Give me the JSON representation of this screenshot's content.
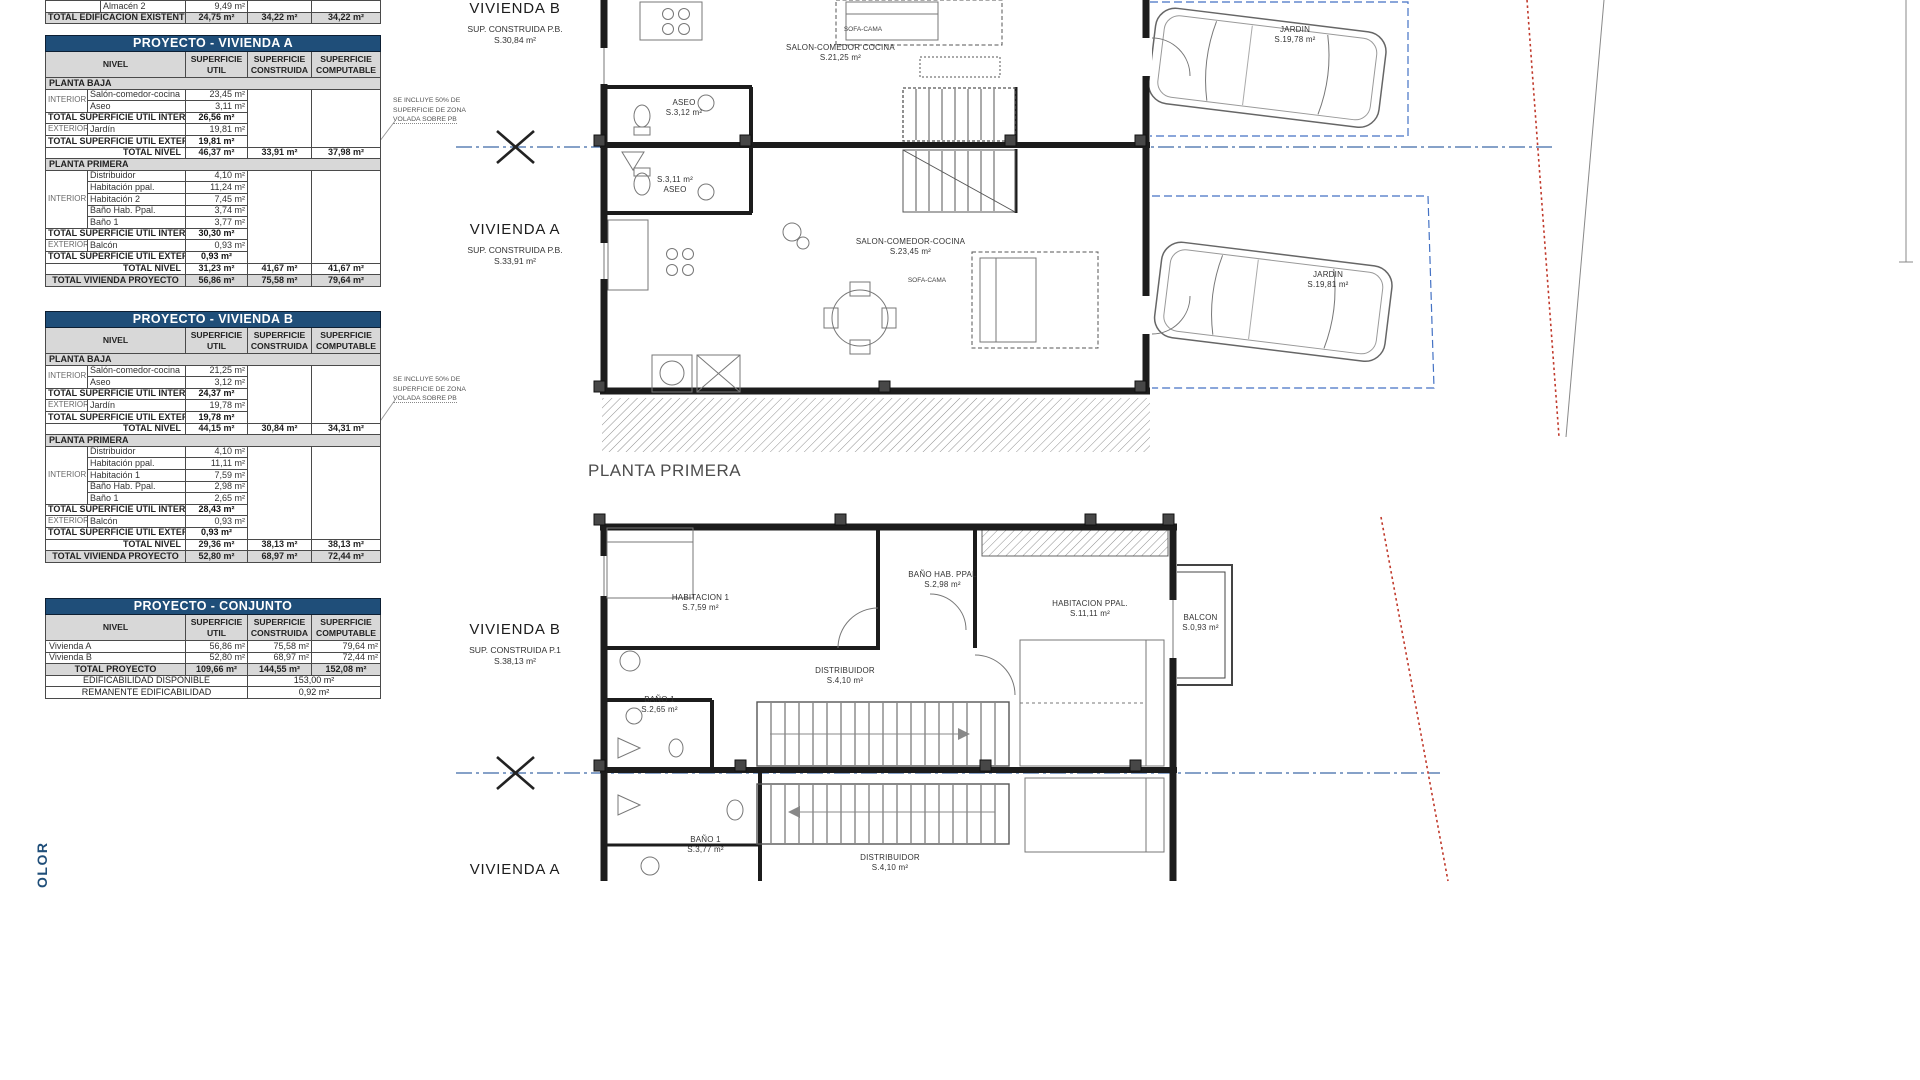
{
  "colors": {
    "header_blue": "#1f4e79",
    "row_grey": "#d8d8d8",
    "section_blue": "#3f69a8",
    "parcel_blue": "#4472c4",
    "boundary_red": "#c0392b"
  },
  "col_headers": {
    "nivel": "NIVEL",
    "util": [
      "SUPERFICIE",
      "UTIL"
    ],
    "construida": [
      "SUPERFICIE",
      "CONSTRUIDA"
    ],
    "computable": [
      "SUPERFICIE",
      "COMPUTABLE"
    ]
  },
  "labels": {
    "planta_baja": "PLANTA BAJA",
    "planta_primera": "PLANTA PRIMERA",
    "interior": "INTERIOR",
    "exterior": "EXTERIOR",
    "total_util_int": "TOTAL SUPERFICIE UTIL INTERIOR",
    "total_util_ext": "TOTAL SUPERFICIE UTIL EXTERIOR",
    "total_nivel": "TOTAL NIVEL",
    "total_vivienda": "TOTAL VIVIENDA PROYECTO"
  },
  "existing_table": {
    "row_almacen": {
      "name": "Almacén 2",
      "util": "9,49 m²"
    },
    "row_total": {
      "label": "TOTAL EDIFICACION EXISTENTE",
      "util": "24,75 m²",
      "construida": "34,22 m²",
      "computable": "34,22 m²"
    }
  },
  "table_a": {
    "title": "PROYECTO - VIVIENDA A",
    "baja": {
      "rooms": [
        [
          "Salón-comedor-cocina",
          "23,45 m²"
        ],
        [
          "Aseo",
          "3,11 m²"
        ]
      ],
      "total_int": "26,56 m²",
      "ext_rooms": [
        [
          "Jardín",
          "19,81 m²"
        ]
      ],
      "total_ext": "19,81 m²",
      "nivel": [
        "46,37 m²",
        "33,91 m²",
        "37,98 m²"
      ]
    },
    "primera": {
      "rooms": [
        [
          "Distribuidor",
          "4,10 m²"
        ],
        [
          "Habitación ppal.",
          "11,24 m²"
        ],
        [
          "Habitación 2",
          "7,45 m²"
        ],
        [
          "Baño Hab. Ppal.",
          "3,74 m²"
        ],
        [
          "Baño 1",
          "3,77 m²"
        ]
      ],
      "total_int": "30,30 m²",
      "ext_rooms": [
        [
          "Balcón",
          "0,93 m²"
        ]
      ],
      "total_ext": "0,93 m²",
      "nivel": [
        "31,23 m²",
        "41,67 m²",
        "41,67 m²"
      ]
    },
    "total": [
      "56,86 m²",
      "75,58 m²",
      "79,64 m²"
    ]
  },
  "table_b": {
    "title": "PROYECTO - VIVIENDA B",
    "baja": {
      "rooms": [
        [
          "Salón-comedor-cocina",
          "21,25 m²"
        ],
        [
          "Aseo",
          "3,12 m²"
        ]
      ],
      "total_int": "24,37 m²",
      "ext_rooms": [
        [
          "Jardín",
          "19,78 m²"
        ]
      ],
      "total_ext": "19,78 m²",
      "nivel": [
        "44,15 m²",
        "30,84 m²",
        "34,31 m²"
      ]
    },
    "primera": {
      "rooms": [
        [
          "Distribuidor",
          "4,10 m²"
        ],
        [
          "Habitación ppal.",
          "11,11 m²"
        ],
        [
          "Habitación 1",
          "7,59 m²"
        ],
        [
          "Baño Hab. Ppal.",
          "2,98 m²"
        ],
        [
          "Baño 1",
          "2,65 m²"
        ]
      ],
      "total_int": "28,43 m²",
      "ext_rooms": [
        [
          "Balcón",
          "0,93 m²"
        ]
      ],
      "total_ext": "0,93 m²",
      "nivel": [
        "29,36 m²",
        "38,13 m²",
        "38,13 m²"
      ]
    },
    "total": [
      "52,80 m²",
      "68,97 m²",
      "72,44 m²"
    ]
  },
  "conjunto": {
    "title": "PROYECTO - CONJUNTO",
    "rows": [
      [
        "Vivienda A",
        "56,86 m²",
        "75,58 m²",
        "79,64 m²"
      ],
      [
        "Vivienda B",
        "52,80 m²",
        "68,97 m²",
        "72,44 m²"
      ]
    ],
    "total_label": "TOTAL PROYECTO",
    "total": [
      "109,66 m²",
      "144,55 m²",
      "152,08 m²"
    ],
    "edificabilidad": [
      "EDIFICABILIDAD DISPONIBLE",
      "153,00 m²"
    ],
    "remanente": [
      "REMANENTE EDIFICABILIDAD",
      "0,92 m²"
    ]
  },
  "note": {
    "l1": "SE INCLUYE 50% DE",
    "l2": "SUPERFICIE DE ZONA",
    "l3": "VOLADA SOBRE PB"
  },
  "plan": {
    "planta_primera_title": "PLANTA PRIMERA",
    "vivienda_b_pb": {
      "name": "VIVIENDA B",
      "sub": "SUP. CONSTRUIDA P.B.",
      "area": "S.30,84 m²"
    },
    "vivienda_a_pb": {
      "name": "VIVIENDA A",
      "sub": "SUP. CONSTRUIDA P.B.",
      "area": "S.33,91 m²"
    },
    "vivienda_b_p1": {
      "name": "VIVIENDA B",
      "sub": "SUP. CONSTRUIDA P.1",
      "area": "S.38,13 m²"
    },
    "vivienda_a_p1": {
      "name": "VIVIENDA A"
    },
    "pb": {
      "salon_b": {
        "name": "SALON-COMEDOR COCINA",
        "area": "S.21,25 m²"
      },
      "sofa_b": "SOFA-CAMA",
      "aseo_b": {
        "name": "ASEO",
        "area": "S.3,12 m²"
      },
      "aseo_a": {
        "area": "S.3,11 m²",
        "name": "ASEO"
      },
      "salon_a": {
        "name": "SALON-COMEDOR-COCINA",
        "area": "S.23,45 m²"
      },
      "sofa_a": "SOFA-CAMA",
      "jardin_b": {
        "name": "JARDIN",
        "area": "S.19,78 m²"
      },
      "jardin_a": {
        "name": "JARDIN",
        "area": "S.19,81 m²"
      }
    },
    "p1": {
      "habitacion1": {
        "name": "HABITACION 1",
        "area": "S.7,59 m²"
      },
      "bano_ppal": {
        "name": "BAÑO HAB. PPAL",
        "area": "S.2,98 m²"
      },
      "hab_ppal": {
        "name": "HABITACION PPAL.",
        "area": "S.11,11 m²"
      },
      "balcon": {
        "name": "BALCON",
        "area": "S.0,93 m²"
      },
      "distribuidor_b": {
        "name": "DISTRIBUIDOR",
        "area": "S.4,10 m²"
      },
      "bano1_b": {
        "name": "BAÑO 1",
        "area": "S.2,65 m²"
      },
      "bano1_a": {
        "name": "BAÑO 1",
        "area": "S.3,77 m²"
      },
      "distribuidor_a": {
        "name": "DISTRIBUIDOR",
        "area": "S.4,10 m²"
      }
    }
  },
  "side_text": "OLOR"
}
